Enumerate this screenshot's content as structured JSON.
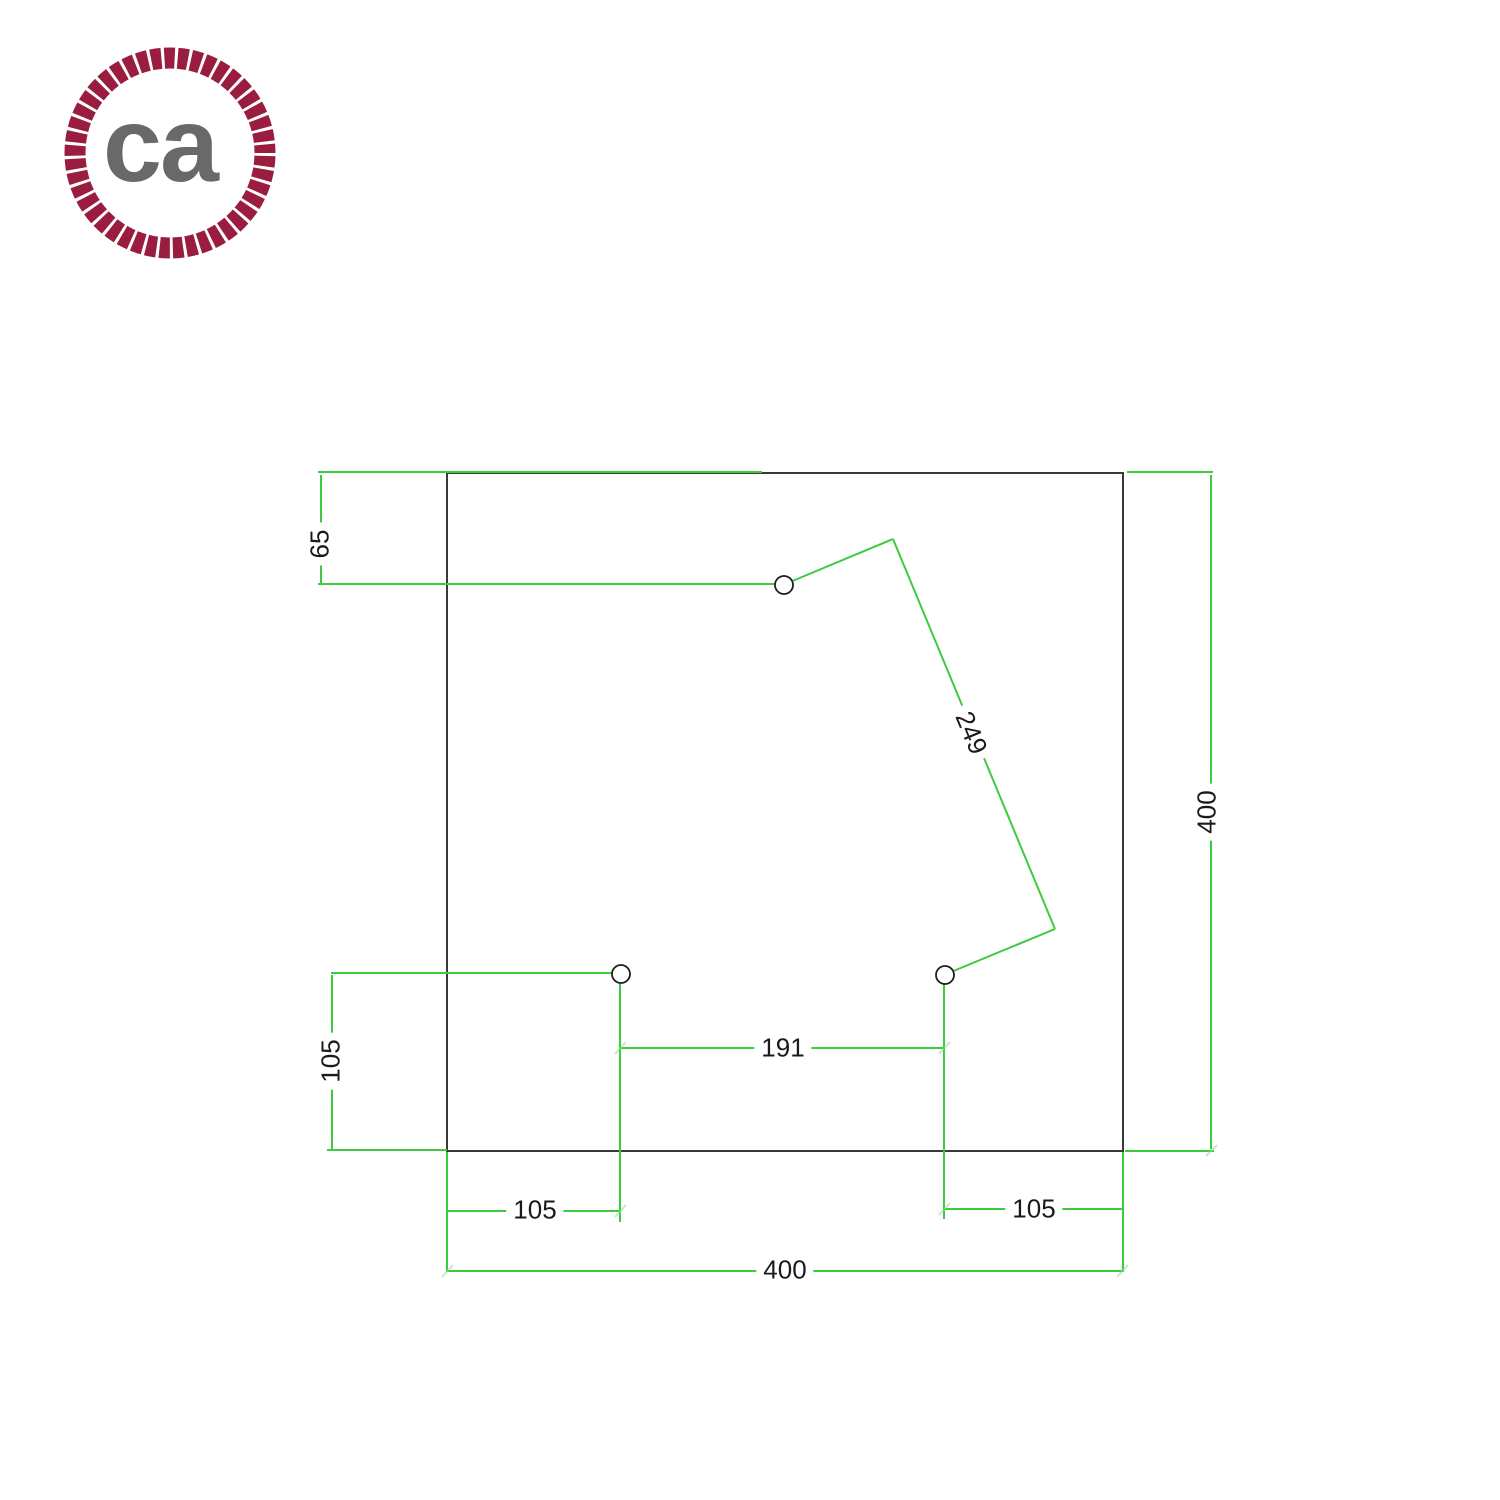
{
  "logo": {
    "text": "ca",
    "ring_color": "#9A1C3F",
    "text_color": "#696969"
  },
  "drawing": {
    "description": "Technical dimension drawing of a square plate with three mounting holes",
    "plate": {
      "shape": "square"
    },
    "holes_count": 3,
    "colors": {
      "dimension_lines": "#3FCB3F",
      "plate_outline": "#3A3A3A",
      "label_text": "#1A1A1A"
    },
    "dimensions": {
      "top_offset": {
        "value": "65"
      },
      "diagonal_span": {
        "value": "249"
      },
      "right_height": {
        "value": "400"
      },
      "left_offset": {
        "value": "105"
      },
      "bottom_center_span": {
        "value": "191"
      },
      "bottom_left_offset": {
        "value": "105"
      },
      "bottom_right_offset": {
        "value": "105"
      },
      "bottom_width": {
        "value": "400"
      }
    }
  }
}
